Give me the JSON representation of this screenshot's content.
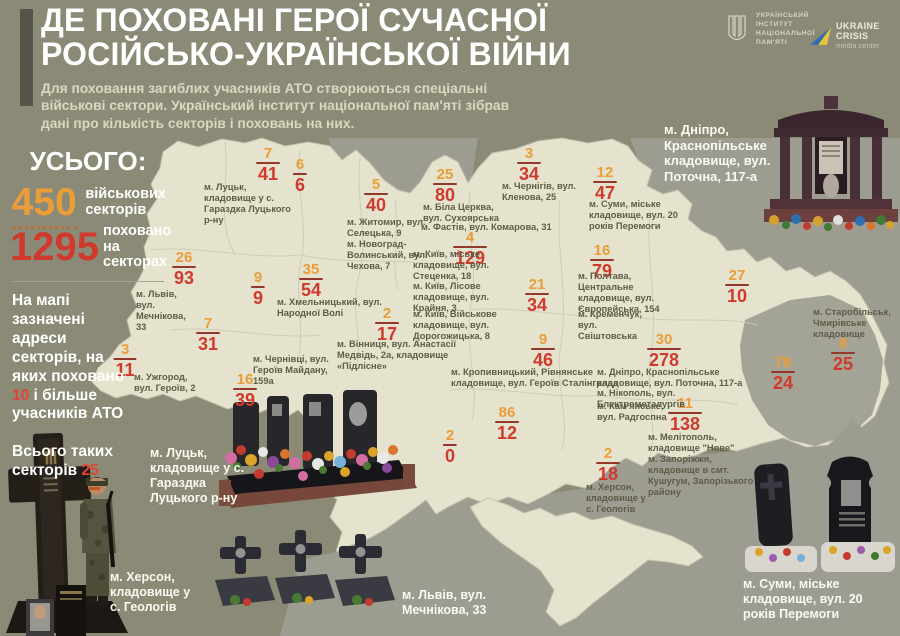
{
  "header": {
    "title_line1": "ДЕ ПОХОВАНІ ГЕРОЇ СУЧАСНОЇ",
    "title_line2": "РОСІЙСЬКО-УКРАЇНСЬКОЇ ВІЙНИ",
    "subtitle": "Для поховання загиблих учасників АТО створюються спеціальні військові сектори. Український інститут національної пам'яті зібрав дані про кількість секторів і поховань на них.",
    "uinp_logo_lines": "УКРАЇНСЬКИЙ ІНСТИТУТ НАЦІОНАЛЬНОЇ ПАМ'ЯТІ",
    "ucmc_name": "UKRAINE CRISIS",
    "ucmc_sub": "media center"
  },
  "stats": {
    "total_label": "УСЬОГО:",
    "sectors_value": "450",
    "sectors_label": "військових секторів",
    "burials_value": "1295",
    "burials_label": "поховано на секторах",
    "note_pre": "На мапі зазначені адреси секторів, на яких поховано ",
    "note_num": "10",
    "note_post": " і більше учасників АТО",
    "note2_pre": "Всього таких секторів ",
    "note2_num": "25"
  },
  "colors": {
    "background": "#8a8a76",
    "map_fill": "#e5e3ce",
    "neighbor_fill": "#9c9c90",
    "accent_orange": "#ea9d39",
    "accent_red": "#d03a2d"
  },
  "map": {
    "fractions": [
      {
        "sectors": "7",
        "burials": "41",
        "x": 268,
        "y": 146
      },
      {
        "sectors": "6",
        "burials": "6",
        "x": 300,
        "y": 157
      },
      {
        "sectors": "5",
        "burials": "40",
        "x": 376,
        "y": 177
      },
      {
        "sectors": "25",
        "burials": "80",
        "x": 445,
        "y": 167
      },
      {
        "sectors": "3",
        "burials": "34",
        "x": 529,
        "y": 146
      },
      {
        "sectors": "12",
        "burials": "47",
        "x": 605,
        "y": 165
      },
      {
        "sectors": "4",
        "burials": "129",
        "x": 470,
        "y": 230
      },
      {
        "sectors": "21",
        "burials": "34",
        "x": 537,
        "y": 277
      },
      {
        "sectors": "16",
        "burials": "79",
        "x": 602,
        "y": 243
      },
      {
        "sectors": "27",
        "burials": "10",
        "x": 737,
        "y": 268
      },
      {
        "sectors": "9",
        "burials": "9",
        "x": 258,
        "y": 270
      },
      {
        "sectors": "35",
        "burials": "54",
        "x": 311,
        "y": 262
      },
      {
        "sectors": "26",
        "burials": "93",
        "x": 184,
        "y": 250
      },
      {
        "sectors": "7",
        "burials": "31",
        "x": 208,
        "y": 316
      },
      {
        "sectors": "2",
        "burials": "17",
        "x": 387,
        "y": 306
      },
      {
        "sectors": "3",
        "burials": "11",
        "x": 125,
        "y": 342
      },
      {
        "sectors": "16",
        "burials": "39",
        "x": 245,
        "y": 372
      },
      {
        "sectors": "9",
        "burials": "46",
        "x": 543,
        "y": 332
      },
      {
        "sectors": "86",
        "burials": "12",
        "x": 507,
        "y": 405
      },
      {
        "sectors": "2",
        "burials": "0",
        "x": 450,
        "y": 428
      },
      {
        "sectors": "30",
        "burials": "278",
        "x": 664,
        "y": 332
      },
      {
        "sectors": "11",
        "burials": "138",
        "x": 685,
        "y": 396
      },
      {
        "sectors": "2",
        "burials": "18",
        "x": 608,
        "y": 446
      },
      {
        "sectors": "78",
        "burials": "24",
        "x": 783,
        "y": 355
      },
      {
        "sectors": "8",
        "burials": "25",
        "x": 843,
        "y": 336
      }
    ],
    "addresses": [
      {
        "text": "м. Луцьк, кладовище у с. Гараздка Луцького р-ну",
        "x": 204,
        "y": 182,
        "w": 88
      },
      {
        "text": "м. Житомир, вул. Селецька, 9",
        "x": 347,
        "y": 217,
        "w": 95
      },
      {
        "text": "м. Новоград-Волинський, вул. Чехова, 7",
        "x": 347,
        "y": 239,
        "w": 82
      },
      {
        "text": "м. Біла Церква, вул. Сухоярська",
        "x": 423,
        "y": 202,
        "w": 92
      },
      {
        "text": "м. Чернігів, вул. Кленова, 25",
        "x": 502,
        "y": 181,
        "w": 88
      },
      {
        "text": "м. Фастів, вул. Комарова, 31",
        "x": 421,
        "y": 222,
        "w": 170
      },
      {
        "text": "м. Київ, міське кладовище, вул. Стеценка, 18",
        "x": 413,
        "y": 249,
        "w": 92
      },
      {
        "text": "м. Київ, Лісове кладовище, вул. Крайня, 3",
        "x": 413,
        "y": 281,
        "w": 80
      },
      {
        "text": "м. Київ, Військове кладовище, вул. Дорогожицька, 8",
        "x": 413,
        "y": 309,
        "w": 100
      },
      {
        "text": "м. Суми, міське кладовище, вул. 20 років Перемоги",
        "x": 589,
        "y": 199,
        "w": 92
      },
      {
        "text": "м. Полтава, Центральне кладовище, вул. Європейська, 154",
        "x": 578,
        "y": 271,
        "w": 92
      },
      {
        "text": "м. Кременчук, вул. Свіштовська",
        "x": 578,
        "y": 309,
        "w": 80
      },
      {
        "text": "м. Хмельницький, вул. Народної Волі",
        "x": 277,
        "y": 297,
        "w": 118
      },
      {
        "text": "м. Львів, вул. Мечнікова, 33",
        "x": 136,
        "y": 289,
        "w": 62
      },
      {
        "text": "м. Вінниця, вул. Анастасії Медвідь, 2а, кладовище «Підлісне»",
        "x": 337,
        "y": 339,
        "w": 120
      },
      {
        "text": "м. Ужгород, вул. Героїв, 2",
        "x": 134,
        "y": 372,
        "w": 74
      },
      {
        "text": "м. Чернівці, вул. Героїв Майдану, 159а",
        "x": 253,
        "y": 354,
        "w": 92
      },
      {
        "text": "м. Кропивницький, Рівнянське кладовище, вул. Героїв Сталінграда",
        "x": 451,
        "y": 367,
        "w": 185
      },
      {
        "text": "м. Дніпро, Краснопільське кладовище, вул. Поточна, 117-а",
        "x": 597,
        "y": 367,
        "w": 168
      },
      {
        "text": "м. Нікополь, вул. Електрометалургів",
        "x": 597,
        "y": 388,
        "w": 165
      },
      {
        "text": "м. Кам'янське, вул. Радгоспна",
        "x": 597,
        "y": 401,
        "w": 72
      },
      {
        "text": "м. Мелітополь, кладовище \"Нове\"",
        "x": 648,
        "y": 432,
        "w": 118
      },
      {
        "text": "м. Запоріжжя, кладовище в смт. Кушугум, Запорізького району",
        "x": 648,
        "y": 454,
        "w": 114
      },
      {
        "text": "м. Херсон, кладовище у с. Геологів",
        "x": 586,
        "y": 482,
        "w": 64
      },
      {
        "text": "м. Старобільськ, Чмирівське кладовище",
        "x": 813,
        "y": 307,
        "w": 80
      }
    ],
    "photo_captions": [
      {
        "text": "м. Дніпро, Краснопільське кладовище, вул. Поточна, 117-а",
        "x": 664,
        "y": 122,
        "w": 128,
        "size": 13
      },
      {
        "text": "м. Луцьк, кладовище у с. Гараздка Луцького р-ну",
        "x": 150,
        "y": 446,
        "w": 98,
        "size": 12.5
      },
      {
        "text": "м. Херсон, кладовище у с. Геологів",
        "x": 110,
        "y": 570,
        "w": 92,
        "size": 12.5
      },
      {
        "text": "м. Львів, вул. Мечнікова, 33",
        "x": 402,
        "y": 588,
        "w": 140,
        "size": 12.5
      },
      {
        "text": "м. Суми, міське кладовище, вул. 20 років Перемоги",
        "x": 743,
        "y": 577,
        "w": 152,
        "size": 12.5
      }
    ]
  }
}
